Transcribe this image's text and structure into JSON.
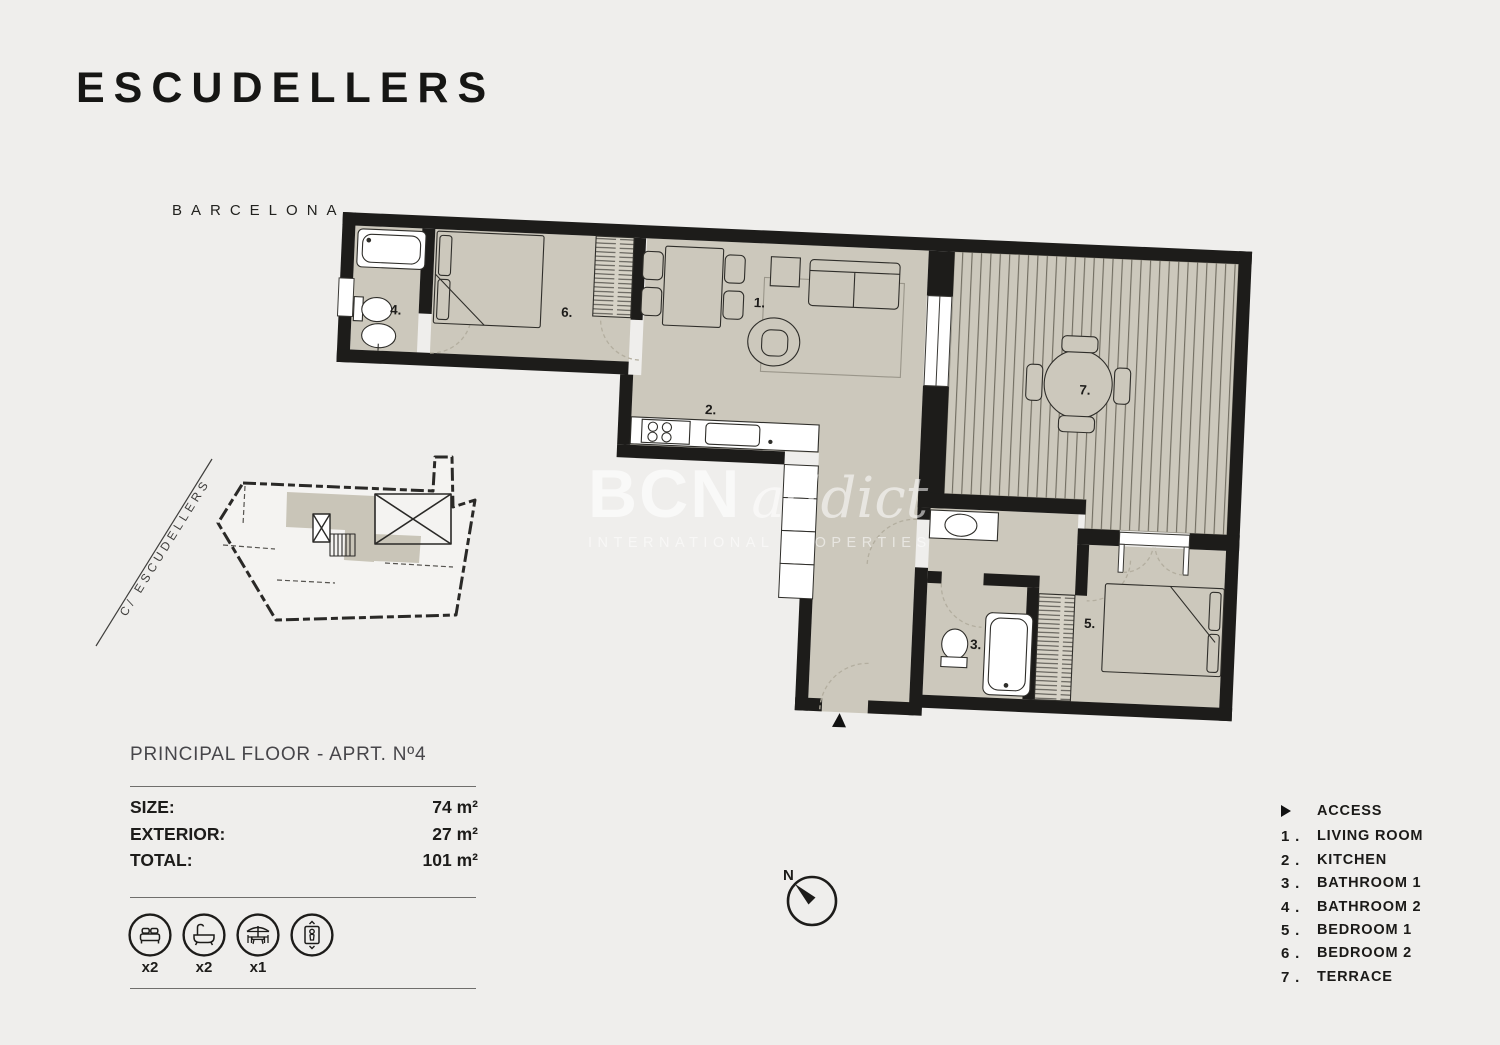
{
  "header": {
    "title": "ESCUDELLERS",
    "city": "BARCELONA"
  },
  "info": {
    "floor_label": "PRINCIPAL FLOOR - APRT. Nº4",
    "rows": [
      {
        "label": "SIZE:",
        "value": "74 m²"
      },
      {
        "label": "EXTERIOR:",
        "value": "27 m²"
      },
      {
        "label": "TOTAL:",
        "value": "101 m²"
      }
    ]
  },
  "amenities": {
    "bed_count": "x2",
    "bath_count": "x2",
    "terrace_count": "x1"
  },
  "legend": {
    "access": {
      "label": "ACCESS"
    },
    "items": [
      {
        "num": "1 .",
        "label": "LIVING ROOM"
      },
      {
        "num": "2 .",
        "label": "KITCHEN"
      },
      {
        "num": "3 .",
        "label": "BATHROOM 1"
      },
      {
        "num": "4 .",
        "label": "BATHROOM 2"
      },
      {
        "num": "5 .",
        "label": "BEDROOM 1"
      },
      {
        "num": "6 .",
        "label": "BEDROOM 2"
      },
      {
        "num": "7 .",
        "label": "TERRACE"
      }
    ]
  },
  "plan": {
    "street_label": "C/ ESCUDELLERS",
    "compass_label": "N",
    "rooms": [
      "1.",
      "2.",
      "3.",
      "4.",
      "5.",
      "6.",
      "7."
    ]
  },
  "watermark": {
    "brand": "BCN",
    "brand_script": "addict",
    "tagline": "INTERNATIONAL PROPERTIES"
  },
  "colors": {
    "background": "#efeeec",
    "walls": "#1d1c1a",
    "floor": "#ccc8bc",
    "terrace_stripe": "#6e6a5e",
    "mini_highlight": "#c9c5b8"
  }
}
